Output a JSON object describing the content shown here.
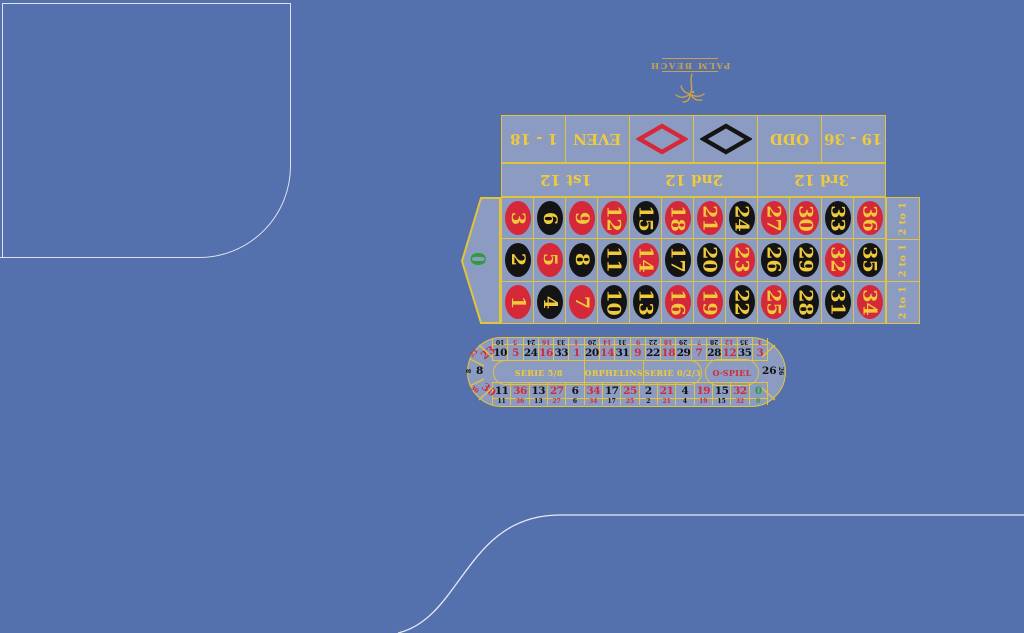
{
  "logo": {
    "text": "PALM BEACH"
  },
  "main_grid": {
    "outside_bets": {
      "low": "1 - 18",
      "even": "EVEN",
      "odd": "ODD",
      "high": "19 - 36"
    },
    "dozens": [
      "1st 12",
      "2nd 12",
      "3rd 12"
    ],
    "column_bet": "2 to 1",
    "zero": "0",
    "rows": [
      [
        3,
        6,
        9,
        12,
        15,
        18,
        21,
        24,
        27,
        30,
        33,
        36
      ],
      [
        2,
        5,
        8,
        11,
        14,
        17,
        20,
        23,
        26,
        29,
        32,
        35
      ],
      [
        1,
        4,
        7,
        10,
        13,
        16,
        19,
        22,
        25,
        28,
        31,
        34
      ]
    ]
  },
  "racetrack": {
    "top": [
      10,
      5,
      24,
      16,
      33,
      1,
      20,
      14,
      31,
      9,
      22,
      18,
      29,
      7,
      28,
      12,
      35,
      3
    ],
    "bottom": [
      11,
      36,
      13,
      27,
      6,
      34,
      17,
      25,
      2,
      21,
      4,
      19,
      15,
      32,
      0
    ],
    "left": [
      23,
      8,
      30
    ],
    "right": 26,
    "sections": {
      "serie58": "SERIE 5/8",
      "orphelins": "ORPHELINS",
      "serie023": "SERIE 0/2/3",
      "ospiel": "O·SPIEL"
    }
  },
  "red_numbers": [
    1,
    3,
    5,
    7,
    9,
    12,
    14,
    16,
    18,
    19,
    21,
    23,
    25,
    27,
    30,
    32,
    34,
    36
  ],
  "colors": {
    "felt": "#5571AD",
    "panel": "#8C9BC1",
    "line": "#E2C43A",
    "red": "#D5293A",
    "black": "#141414",
    "green": "#2E9C39",
    "number": "#EFCB3B",
    "logo": "#C7A24E",
    "edge": "rgba(255,255,255,0.85)"
  }
}
